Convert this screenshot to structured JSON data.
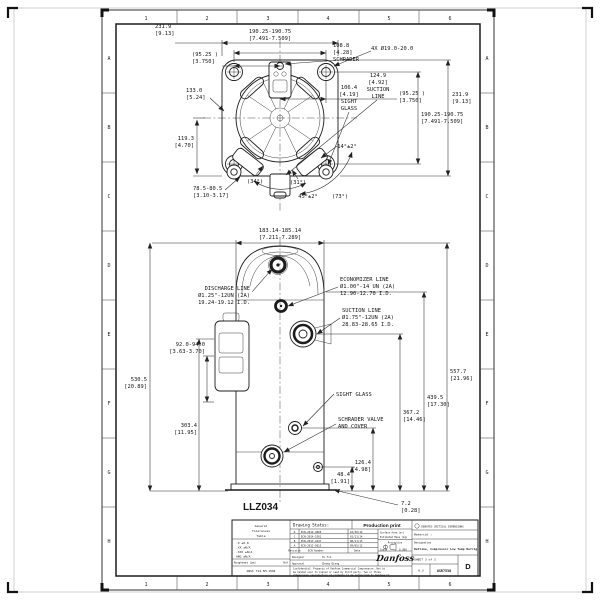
{
  "colors": {
    "ink": "#1c1c1c",
    "paper": "#ffffff"
  },
  "sheet": {
    "zone_letters": [
      "A",
      "B",
      "C",
      "D",
      "E",
      "F",
      "G",
      "H"
    ],
    "zone_numbers": [
      "1",
      "2",
      "3",
      "4",
      "5",
      "6"
    ]
  },
  "top_view": {
    "dim_width_mm": "231.9",
    "dim_width_in": "[9.13]",
    "dim_holes_mm": "190.25-190.75",
    "dim_holes_in": "[7.491-7.509]",
    "dim_half_mm": "(95.25 )",
    "dim_half_in": "[3.750]",
    "dim_133_mm": "133.0",
    "dim_133_in": "[5.24]",
    "dim_119_mm": "119.3",
    "dim_119_in": "[4.70]",
    "schrader_mm": "108.8",
    "schrader_in": "[4.28]",
    "schrader_label": "SCHRADER",
    "holes_note": "4X Ø19.0-20.0",
    "suction_mm": "124.9",
    "suction_in": "[4.92]",
    "suction_l1": "SUCTION",
    "suction_l2": "LINE",
    "sight_mm": "106.4",
    "sight_in": "[4.19]",
    "sight_l1": "SIGHT",
    "sight_l2": "GLASS",
    "dim_half2_mm": "(95.25 )",
    "dim_half2_in": "[3.750]",
    "dim_width2_mm": "231.9",
    "dim_width2_in": "[9.13]",
    "dim_holes2_mm": "190.25-190.75",
    "dim_holes2_in": "[7.491-7.509]",
    "dim_785_mm": "78.5-80.5",
    "dim_785_in": "[3.10-3.17]",
    "ang_34": "(34°)",
    "ang_31": "(31°)",
    "ang_45": "45°±2°",
    "ang_73": "(73°)",
    "ang_14": "14°±2°"
  },
  "front_view": {
    "dim_top_mm": "183.14-185.14",
    "dim_top_in": "[7.211-7.289]",
    "discharge_l1": "DISCHARGE LINE",
    "discharge_l2": "Ø1.25\"-12UN (2A)",
    "discharge_l3": "19.24-19.12 I.D.",
    "economizer_l1": "ECONOMIZER LINE",
    "economizer_l2": "Ø1.00\"-14 UN (2A)",
    "economizer_l3": "12.90-12.70 I.D.",
    "suction_l1": "SUCTION LINE",
    "suction_l2": "Ø1.75\"-12UN (2A)",
    "suction_l3": "28.83-28.65 I.D.",
    "dim_92_mm": "92.0-94.0",
    "dim_92_in": "[3.63-3.70]",
    "dim_530_mm": "530.5",
    "dim_530_in": "[20.89]",
    "dim_303_mm": "303.4",
    "dim_303_in": "[11.95]",
    "dim_557_mm": "557.7",
    "dim_557_in": "[21.96]",
    "dim_439_mm": "439.5",
    "dim_439_in": "[17.30]",
    "dim_367_mm": "367.2",
    "dim_367_in": "[14.46]",
    "dim_126_mm": "126.4",
    "dim_126_in": "[4.98]",
    "dim_48_mm": "48.4",
    "dim_48_in": "[1.91]",
    "dim_72_mm": "7.2",
    "dim_72_in": "[0.28]",
    "sight_glass_label": "SIGHT GLASS",
    "schrader_l1": "SCHRADER VALVE",
    "schrader_l2": "AND COVER",
    "model": "LLZ034"
  },
  "title_block": {
    "tol_header_l1": "General",
    "tol_header_l2": "Tolerances",
    "tol_header_l3": "Table",
    "tol_rows": [
      ".X ±0.8",
      ".XX ±N/A",
      ".XXX ±N/A",
      "ANG ±N/A"
    ],
    "roughness_label": "Roughness (μm)",
    "roughness_value": "N/A",
    "standard": "ANSI Y14.5M-1994",
    "status_label": "Drawing Status:",
    "status_value": "Production print",
    "surface_label": "Surface Area (m²)",
    "mass_label": "Estimated Mass (kg)",
    "rev_header": {
      "rev": "Revision",
      "ecn": "ECN Number",
      "date": "Date"
    },
    "revisions": [
      {
        "rev": "D",
        "ecn": "ECN-2014-4005",
        "date": "10/30/14"
      },
      {
        "rev": "C",
        "ecn": "ECN-2014-5261",
        "date": "01/11/14"
      },
      {
        "rev": "B",
        "ecn": "ECN-2013-4247",
        "date": "08/11/13"
      },
      {
        "rev": "A",
        "ecn": "ECN-2012-5013",
        "date": "09/05/12"
      }
    ],
    "designer_label": "Designer",
    "designer_value": "Yu Yin",
    "approval_label": "Approval",
    "approval_value": "Zhang Qiang",
    "projection_label": "Projection",
    "scale_label": "Scale",
    "scale_value": "0.300",
    "logo_text": "Danfoss",
    "confidential_l1": "Confidential: Property of Danfoss Commercial Compressors. Not to",
    "confidential_l2": "be handed over to copied or used by third party. Two or three",
    "confidential_l3": "dimensional reproduction of contents to be authorized by Danfoss CC.",
    "critical_note": "DENOTES CRITICAL DIMENSIONS",
    "material_label": "Material :",
    "designation_label": "Designation",
    "designation_value": "Outline, Compressor Low Temp Refrig",
    "sheet_label": "SHEET 3 of 3",
    "sheet_small": "0.3",
    "drawing_number": "OSR7530",
    "revision_current": "D"
  }
}
